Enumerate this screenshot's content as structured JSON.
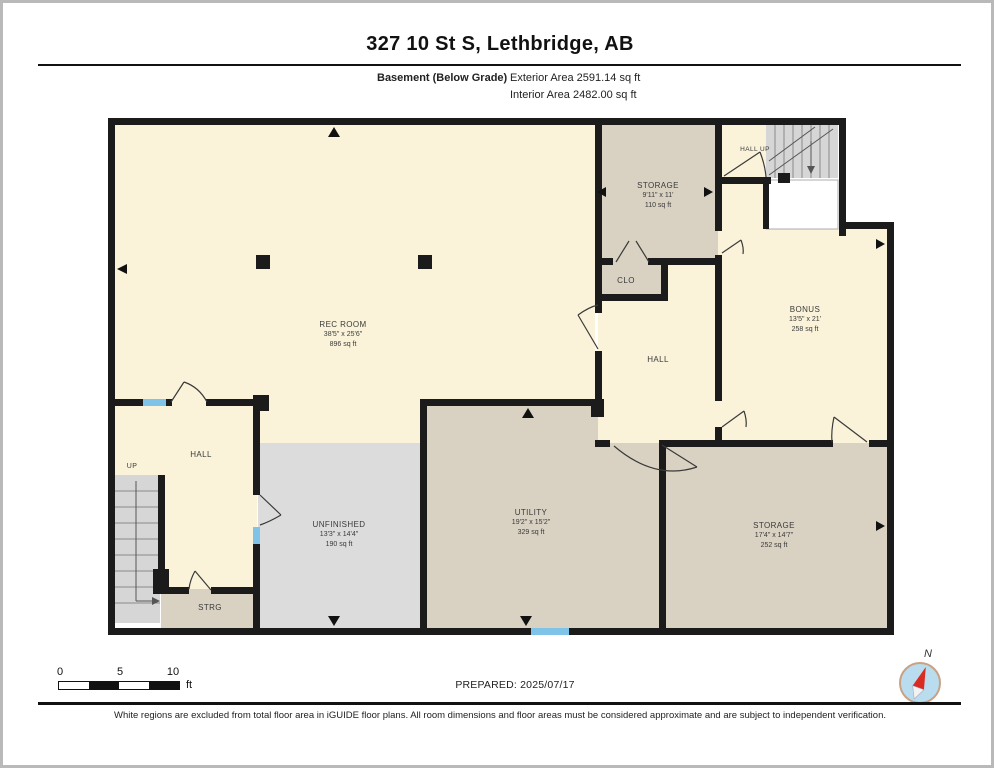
{
  "header": {
    "title": "327 10 St S, Lethbridge, AB",
    "floor_label": "Basement (Below Grade)",
    "exterior_area": "Exterior Area 2591.14 sq ft",
    "interior_area": "Interior Area 2482.00 sq ft"
  },
  "rooms": {
    "rec": {
      "name": "REC ROOM",
      "dims": "38'5\" x 25'6\"",
      "area": "896 sq ft"
    },
    "storage_top": {
      "name": "STORAGE",
      "dims": "9'11\" x 11'",
      "area": "110 sq ft"
    },
    "hall_up": {
      "name": "HALL UP"
    },
    "bonus": {
      "name": "BONUS",
      "dims": "13'5\" x 21'",
      "area": "258 sq ft"
    },
    "clo": {
      "name": "CLO"
    },
    "hall_mid": {
      "name": "HALL"
    },
    "hall_left": {
      "name": "HALL"
    },
    "up": {
      "name": "UP"
    },
    "strg": {
      "name": "STRG"
    },
    "unfinished": {
      "name": "UNFINISHED",
      "dims": "13'3\" x 14'4\"",
      "area": "190 sq ft"
    },
    "utility": {
      "name": "UTILITY",
      "dims": "19'2\" x 15'2\"",
      "area": "329 sq ft"
    },
    "storage_bottom": {
      "name": "STORAGE",
      "dims": "17'4\" x 14'7\"",
      "area": "252 sq ft"
    }
  },
  "scale_bar": {
    "tick0": "0",
    "tick5": "5",
    "tick10": "10",
    "unit": "ft"
  },
  "prepared": "PREPARED: 2025/07/17",
  "compass": {
    "north": "N"
  },
  "footer": "White regions are excluded from total floor area in iGUIDE floor plans. All room dimensions and floor areas must be considered approximate and are subject to independent verification.",
  "colors": {
    "cream": "#FAF3DA",
    "tan": "#D9D1C2",
    "room_gray": "#DCDCDC",
    "wall": "#1B1B1B",
    "window_blue": "#7FC3E8",
    "needle_red": "#D92B21",
    "compass_fill": "#BADCEF",
    "compass_ring": "#C9A184"
  }
}
